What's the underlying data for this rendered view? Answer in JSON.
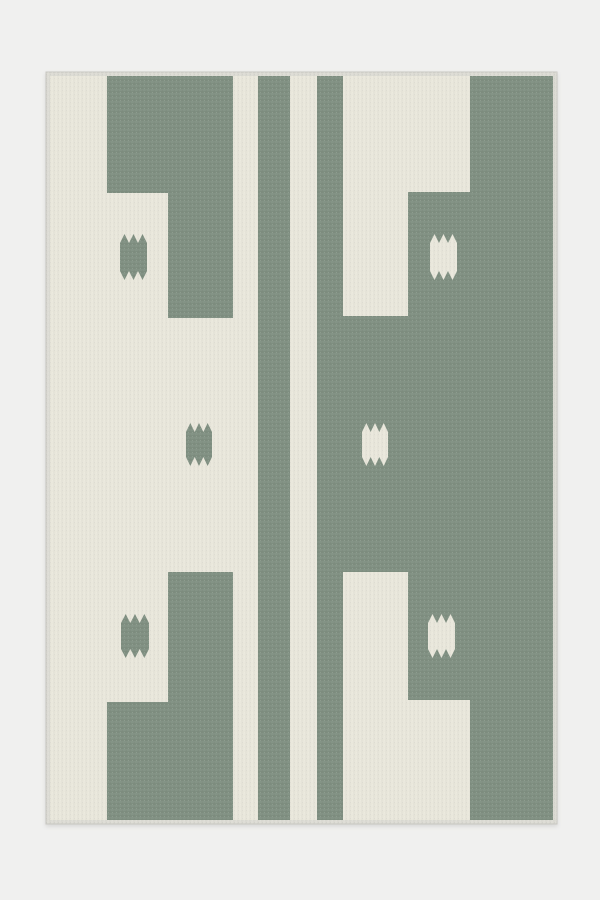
{
  "scene": {
    "type": "product-photo",
    "subject": "geometric flatweave area rug in sage green and ivory, flat view on light studio background",
    "background_color": "#F0F0EF"
  },
  "rug": {
    "frame": {
      "x": 46,
      "y": 72,
      "width": 511,
      "height": 752
    },
    "content": {
      "x": 50,
      "y": 76,
      "width": 503,
      "height": 744
    },
    "colors": {
      "ivory": "#E9E7DB",
      "green": "#7E8E80",
      "binding": "#DCDBD4",
      "edge_line": "#C9C8C2",
      "shadow": "rgba(0,0,0,0.10)"
    }
  },
  "pattern": {
    "green_polygons": [
      {
        "name": "top-left-block",
        "points": [
          [
            107,
            76
          ],
          [
            233,
            76
          ],
          [
            233,
            318
          ],
          [
            168,
            318
          ],
          [
            168,
            193
          ],
          [
            107,
            193
          ]
        ]
      },
      {
        "name": "bottom-left-block",
        "points": [
          [
            168,
            572
          ],
          [
            233,
            572
          ],
          [
            233,
            820
          ],
          [
            107,
            820
          ],
          [
            107,
            702
          ],
          [
            168,
            702
          ]
        ]
      }
    ],
    "green_rects": [
      {
        "name": "center-stripe-left",
        "x": 258,
        "y": 76,
        "w": 32,
        "h": 744
      },
      {
        "name": "center-stripe-right",
        "x": 317,
        "y": 76,
        "w": 26,
        "h": 744
      },
      {
        "name": "right-field-top",
        "x": 470,
        "y": 76,
        "w": 83,
        "h": 116
      },
      {
        "name": "right-field-upper",
        "x": 408,
        "y": 192,
        "w": 145,
        "h": 124
      },
      {
        "name": "right-field-middle",
        "x": 343,
        "y": 316,
        "w": 210,
        "h": 256
      },
      {
        "name": "right-field-lower",
        "x": 408,
        "y": 572,
        "w": 145,
        "h": 128
      },
      {
        "name": "right-field-bottom",
        "x": 470,
        "y": 700,
        "w": 83,
        "h": 120
      }
    ],
    "serrated_squares": [
      {
        "name": "top-left-motif",
        "x": 120,
        "y": 234,
        "w": 27,
        "h": 46,
        "fill": "green"
      },
      {
        "name": "top-right-motif",
        "x": 430,
        "y": 234,
        "w": 27,
        "h": 46,
        "fill": "ivory"
      },
      {
        "name": "middle-left-motif",
        "x": 186,
        "y": 423,
        "w": 26,
        "h": 43,
        "fill": "green"
      },
      {
        "name": "middle-right-motif",
        "x": 362,
        "y": 423,
        "w": 26,
        "h": 43,
        "fill": "ivory"
      },
      {
        "name": "bottom-left-motif",
        "x": 121,
        "y": 614,
        "w": 28,
        "h": 44,
        "fill": "green"
      },
      {
        "name": "bottom-right-motif",
        "x": 428,
        "y": 614,
        "w": 27,
        "h": 44,
        "fill": "ivory"
      }
    ],
    "teeth_per_edge": 3,
    "tooth_depth": 9
  }
}
